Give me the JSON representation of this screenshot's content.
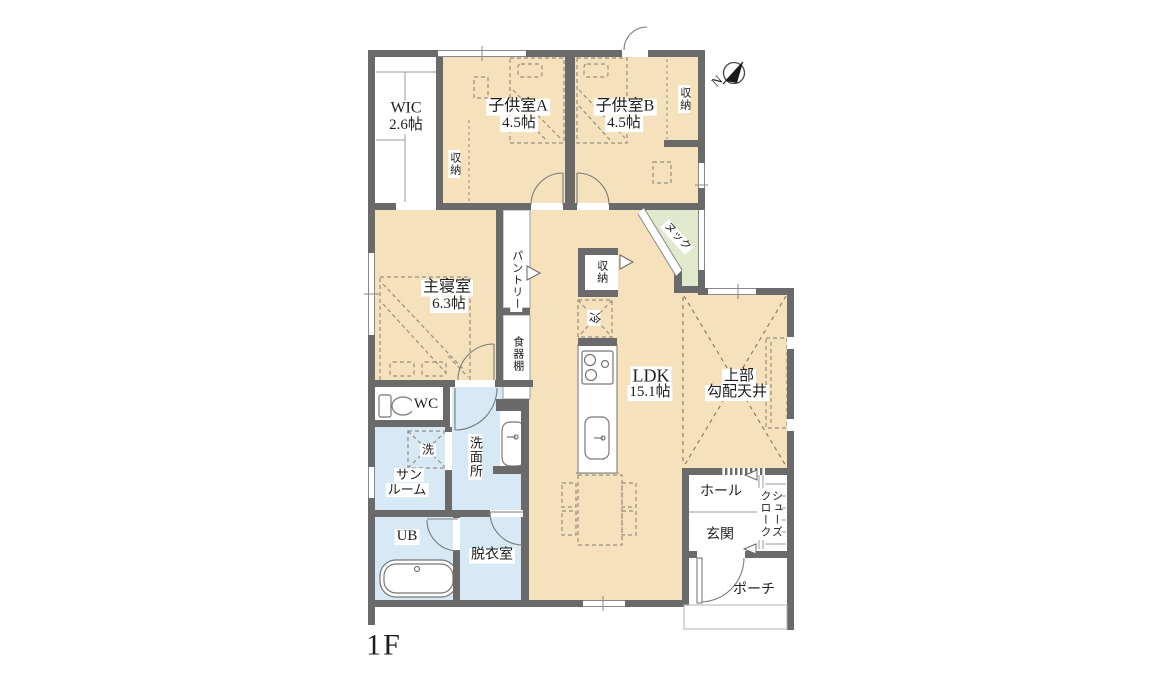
{
  "plan_title": "1F",
  "compass": {
    "letter": "N"
  },
  "labels": {
    "wic_name": "WIC",
    "wic_size": "2.6帖",
    "kids_a_name": "子供室A",
    "kids_a_size": "4.5帖",
    "kids_b_name": "子供室B",
    "kids_b_size": "4.5帖",
    "storage": "収納",
    "master_name": "主寝室",
    "master_size": "6.3帖",
    "pantry": "パントリー",
    "cupboard": "食器棚",
    "fridge": "冷",
    "nook": "ヌック",
    "ldk_name": "LDK",
    "ldk_size": "15.1帖",
    "sloped_1": "上部",
    "sloped_2": "勾配天井",
    "wc": "WC",
    "washer": "洗",
    "sunroom_1": "サン",
    "sunroom_2": "ルーム",
    "washroom": "洗面所",
    "ub": "UB",
    "dressing": "脱衣室",
    "hall": "ホール",
    "entrance": "玄関",
    "shoe_closet": "シューズ\nクローク",
    "porch": "ポーチ"
  },
  "colors": {
    "wall": "#6a6a6a",
    "floor_beige": "#f5e2bc",
    "floor_blue": "#d6e9f4",
    "floor_green": "#e0e8ce",
    "thin_line": "#8c8c8c",
    "dash_furniture": "#998f7f"
  }
}
